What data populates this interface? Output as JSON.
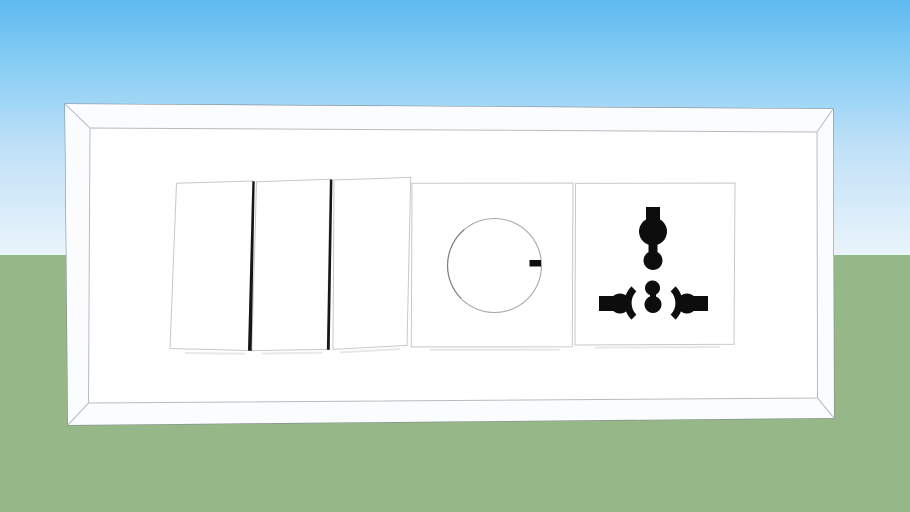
{
  "scene": {
    "description": "3D viewport render of a white multi-gang wall plate with three rocker switches, a rotary dimmer and a universal power socket, shown against a sky and ground backdrop",
    "sky_top_color": "#5ebbf1",
    "sky_upper_color": "#86cdf4",
    "sky_mid_color": "#c0e1f7",
    "sky_horizon_color": "#eaf4fb",
    "ground_color": "#96b888",
    "horizon_y": 255
  },
  "colors": {
    "plate_fill": "#ffffff",
    "plate_outline": "#82888e",
    "bevel_line": "#b7bbc0",
    "bevel_face": "#fbfcfd",
    "module_border": "#c6c8cb",
    "gap_shadow": "#161616",
    "knob_outline": "#a6a9ad",
    "indicator": "#101010",
    "pin_holes": "#0d0d0d"
  },
  "plate": {
    "gang_count": 5,
    "modules": [
      {
        "type": "rocker-switch",
        "name": "rocker switch 1"
      },
      {
        "type": "rocker-switch",
        "name": "rocker switch 2"
      },
      {
        "type": "rocker-switch",
        "name": "rocker switch 3"
      },
      {
        "type": "rotary-dimmer",
        "name": "dimmer knob",
        "indicator_position": "3 o'clock"
      },
      {
        "type": "universal-socket",
        "name": "universal power socket",
        "hole_groups": [
          "earth slot column",
          "center round pair",
          "left live slot",
          "right neutral slot"
        ]
      }
    ],
    "switch_count": 3
  }
}
